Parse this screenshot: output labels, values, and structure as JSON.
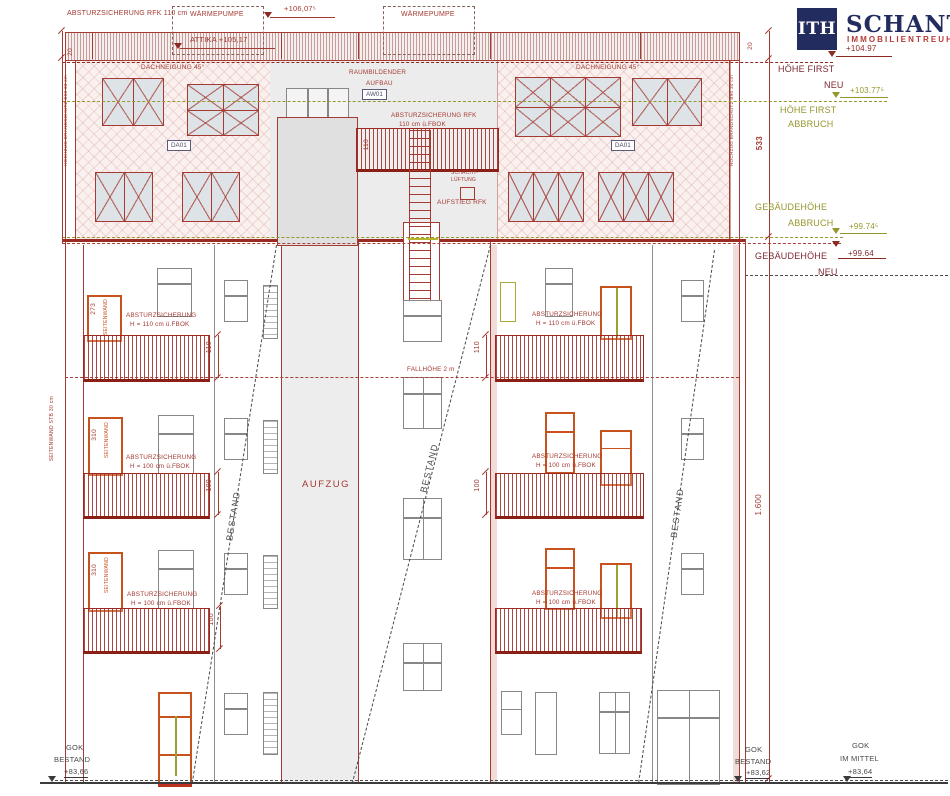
{
  "logo": {
    "mark": "ITH",
    "name": "SCHANTL",
    "subtitle": "IMMOBILIENTREUHAND"
  },
  "top": {
    "absturz_label": "ABSTURZSICHERUNG RFK 110 cm",
    "waermepumpe": "WÄRMEPUMPE",
    "level_106": "+106,07⁵",
    "attika": "ATTIKA +105,17",
    "dim_20": "20"
  },
  "roof": {
    "dachneigung": "DACHNEIGUNG 45°",
    "da01": "DA01",
    "raum_line1": "RAUMBILDENDER",
    "raum_line2": "AUFBAU",
    "aw01": "AW01",
    "absturz_line1": "ABSTURZSICHERUNG RFK",
    "absturz_line2": "110 cm ü.FBOK",
    "dim_110": "110",
    "schacht_line1": "SCHACHT-",
    "schacht_line2": "LÜFTUNG",
    "aufstieg": "AUFSTIEG RFK",
    "hochzug": "HOCHZUG BRANDSCHUTZ B90 30 cm"
  },
  "right_margin": {
    "level_104": "+104.97",
    "first_label": "HÖHE FIRST",
    "neu": "NEU",
    "level_103": "+103.77⁵",
    "abbruch": "ABBRUCH",
    "dim_533": "533",
    "gebaeudehoehe": "GEBÄUDEHÖHE",
    "level_99_74": "+99.74⁵",
    "level_99_64": "+99.64",
    "dim_1600": "1.600"
  },
  "facade": {
    "absturz": "ABSTURZSICHERUNG",
    "h_110": "H = 110 cm ü.FBOK",
    "h_100": "H = 100 cm ü.FBOK",
    "fallhoehe": "FALLHÖHE 2 m",
    "aufzug": "AUFZUG",
    "bestand": "BESTAND",
    "dim_110": "110",
    "dim_100": "100",
    "dim_273": "273",
    "dim_310": "310",
    "seitenwand": "SEITENWAND",
    "seitenwand_stb": "SEITENWAND STB 30 cm"
  },
  "bottom": {
    "gok": "GOK",
    "bestand": "BESTAND",
    "im_mittel": "IM MITTEL",
    "level_left": "+83,66",
    "level_right": "+83,62",
    "level_mittel": "+83,64"
  },
  "colors": {
    "drawing_red": "#a43a32",
    "abbruch_olive": "#96962e",
    "navy": "#232c5e",
    "logo_red": "#b63a34",
    "highlight_orange": "#c8521c"
  }
}
